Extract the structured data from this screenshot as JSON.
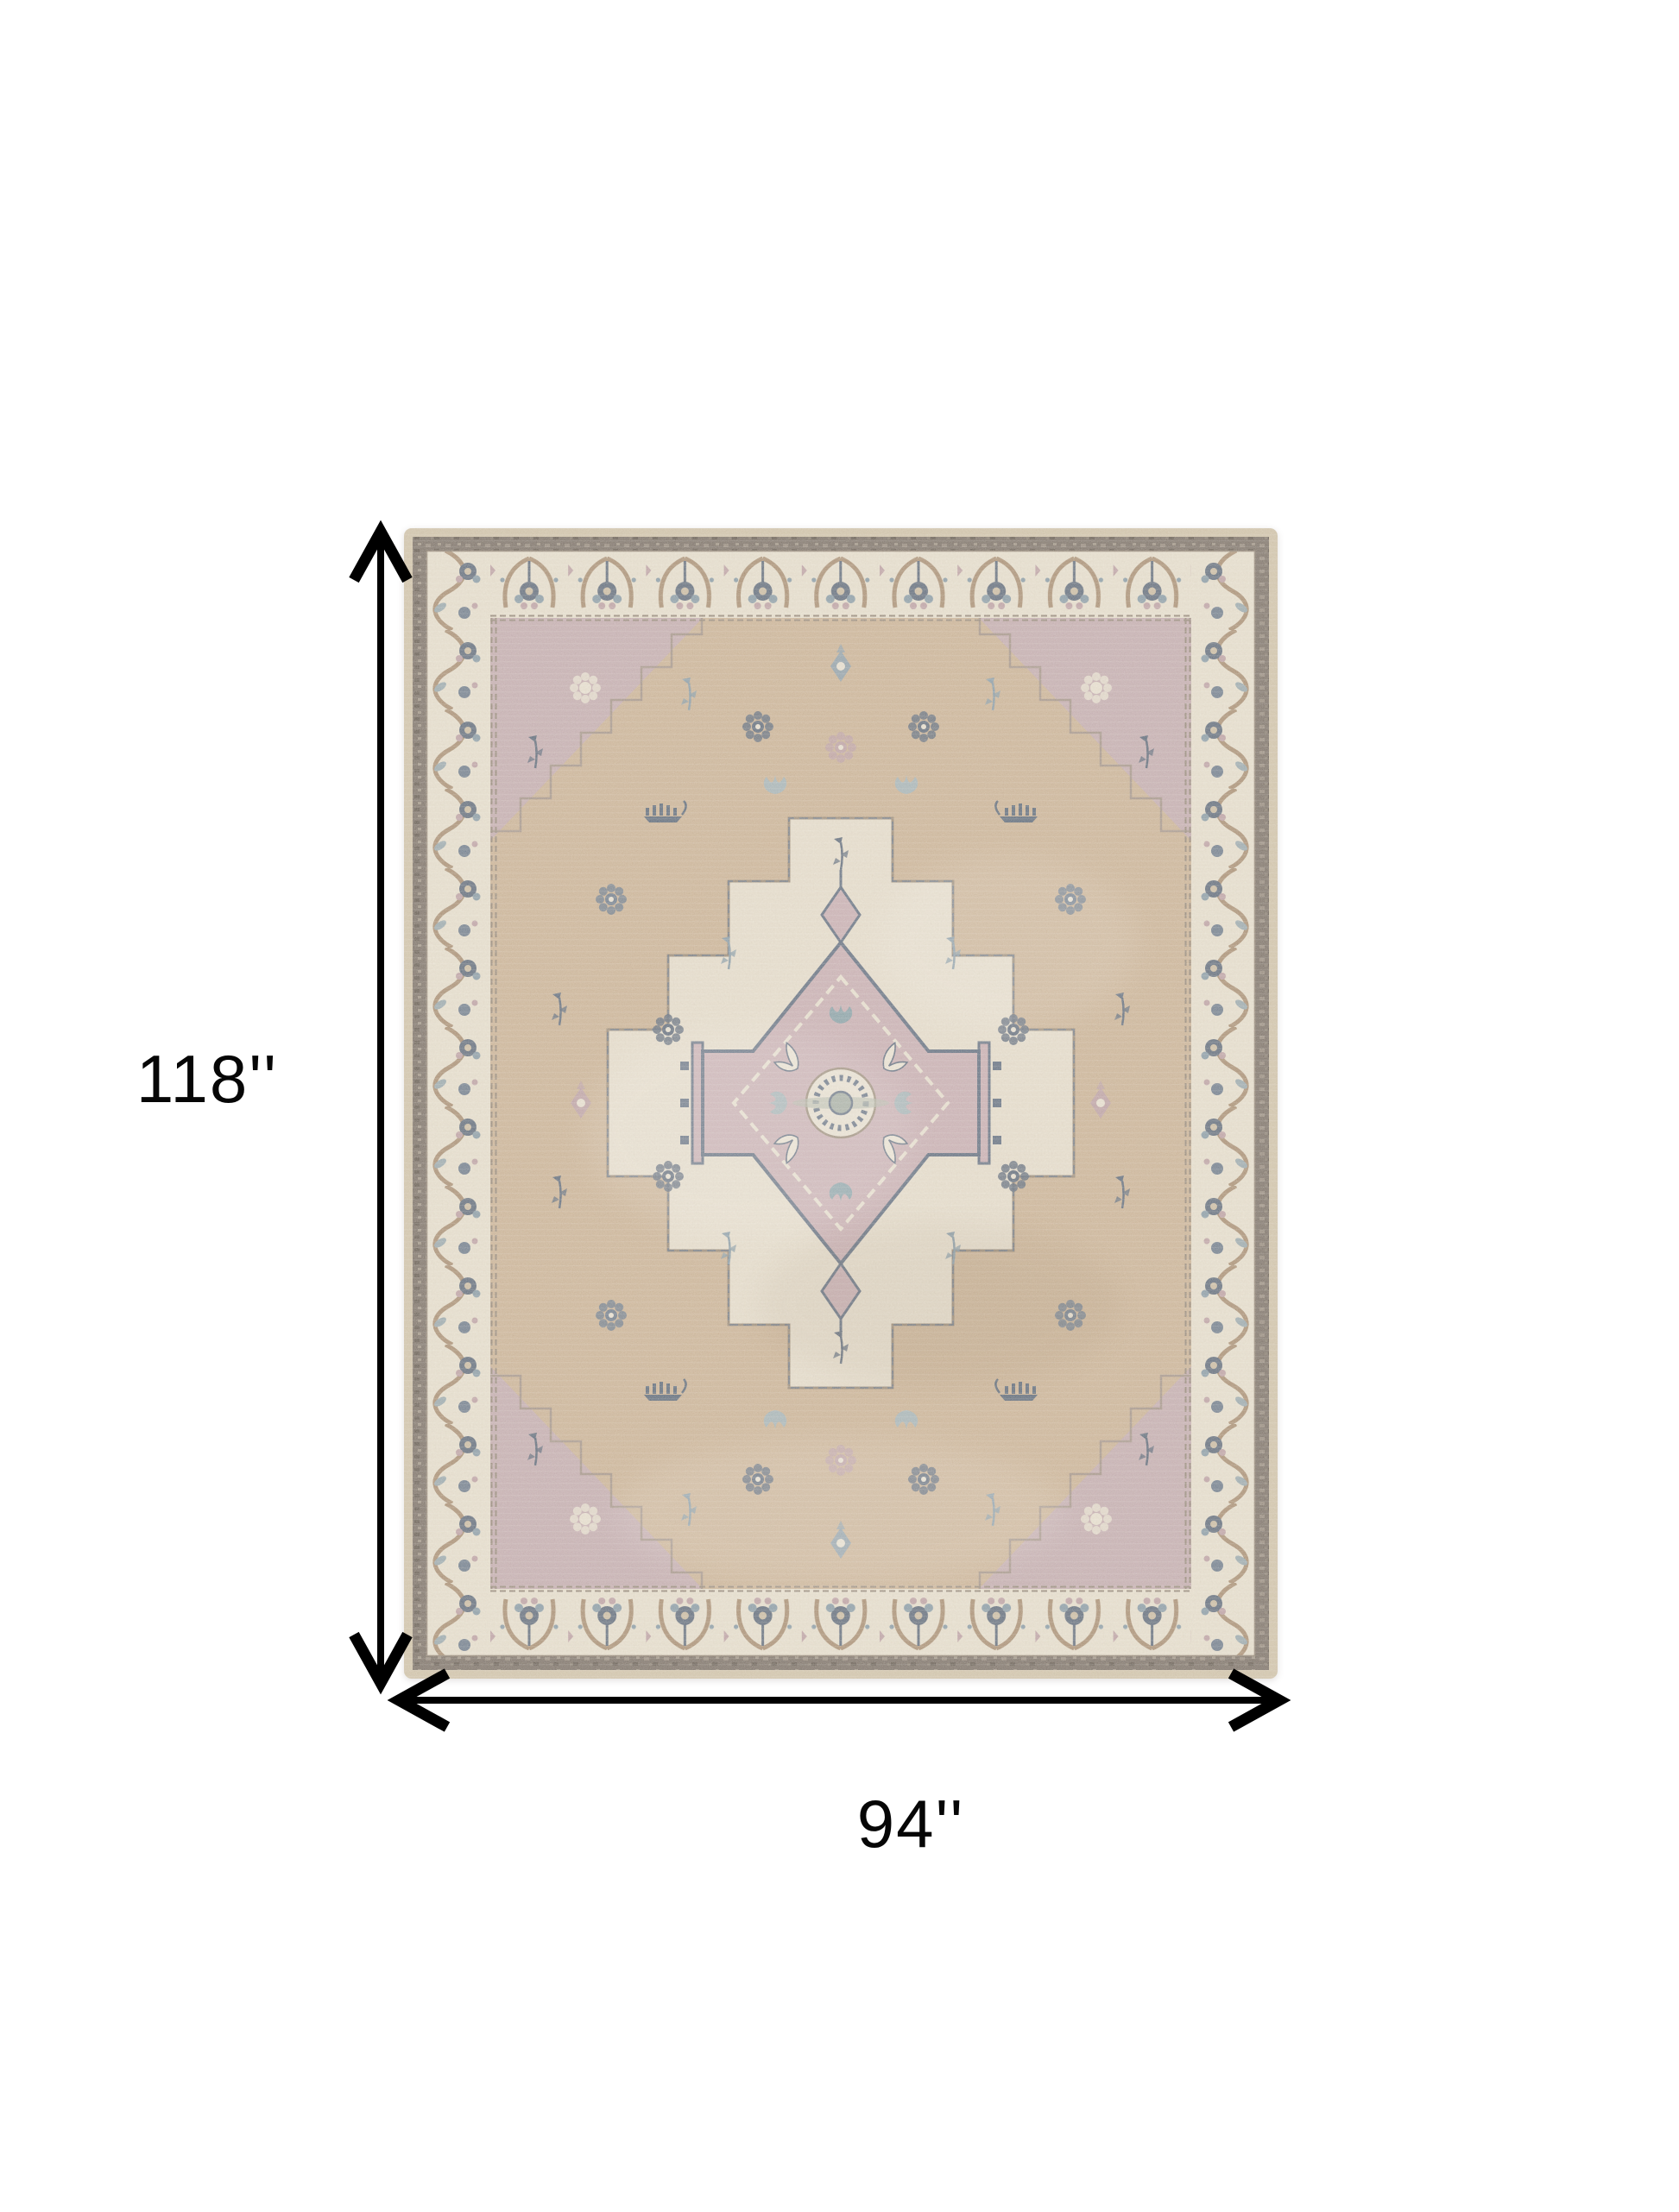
{
  "page": {
    "background": "#ffffff"
  },
  "diagram": {
    "height_label": "118''",
    "width_label": "94''",
    "arrow_color": "#000000"
  },
  "rug": {
    "alt": "Beige and mauve distressed oriental area rug with central stepped medallion, mauve corner spandrels and ornate ivory palmette borders",
    "palette": {
      "field_tan": "#c8ae90",
      "spandrel_mauve": "#c0a7af",
      "border_ivory": "#e8e1d1",
      "medallion_mauve": "#c5a9b2",
      "medallion_ivory": "#e7dfcf",
      "accent_navy": "#4b5b72",
      "accent_blue": "#7b93a4",
      "accent_tan": "#a08468",
      "edge_dark": "#6b615a",
      "selvage": "#cfc2a8"
    }
  }
}
